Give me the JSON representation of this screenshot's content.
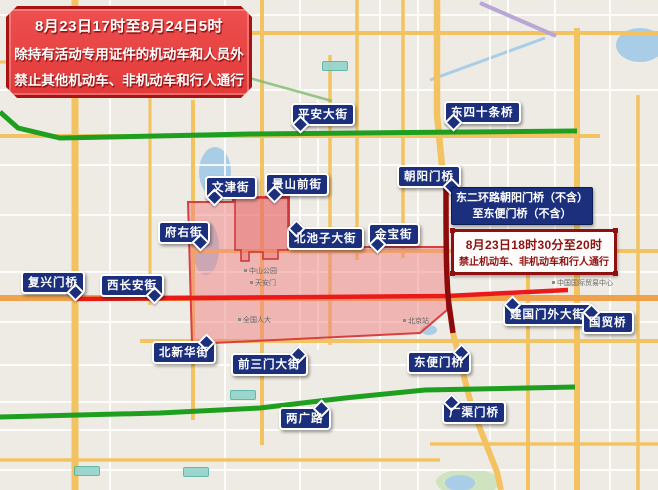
{
  "notice_main": {
    "line1": "8月23日17时至8月24日5时",
    "line2": "除持有活动专用证件的机动车和人员外",
    "line3": "禁止其他机动车、非机动车和行人通行"
  },
  "notice_blue": {
    "line1": "东二环路朝阳门桥（不含）",
    "line2": "至东便门桥（不含）"
  },
  "notice_red": {
    "line1": "8月23日18时30分至20时",
    "line2": "禁止机动车、非机动车和行人通行"
  },
  "street_labels": [
    {
      "text": "平安大街"
    },
    {
      "text": "东四十条桥"
    },
    {
      "text": "文津街"
    },
    {
      "text": "景山前街"
    },
    {
      "text": "朝阳门桥"
    },
    {
      "text": "府右街"
    },
    {
      "text": "北池子大街"
    },
    {
      "text": "金宝街"
    },
    {
      "text": "复兴门桥"
    },
    {
      "text": "西长安街"
    },
    {
      "text": "北新华街"
    },
    {
      "text": "前三门大街"
    },
    {
      "text": "东便门桥"
    },
    {
      "text": "两广路"
    },
    {
      "text": "广渠门桥"
    },
    {
      "text": "建国门外大街"
    },
    {
      "text": "国贸桥"
    }
  ],
  "map": {
    "pois": [
      {
        "text": "中山公园"
      },
      {
        "text": "天安门"
      },
      {
        "text": "全国人大"
      },
      {
        "text": "北京站"
      },
      {
        "text": "中国国际贸易中心"
      }
    ],
    "colors": {
      "restricted_zone_fill": "#f08080",
      "restricted_zone_border": "#d84040",
      "closed_road_red": "#ea1a1a",
      "ring_road_dark_red": "#8e0b0b",
      "open_road_green": "#1f9f1f",
      "label_navy": "#1b2f7d",
      "notice_red": "#e23a3a",
      "main_road_yellow": "#f3c361"
    }
  }
}
